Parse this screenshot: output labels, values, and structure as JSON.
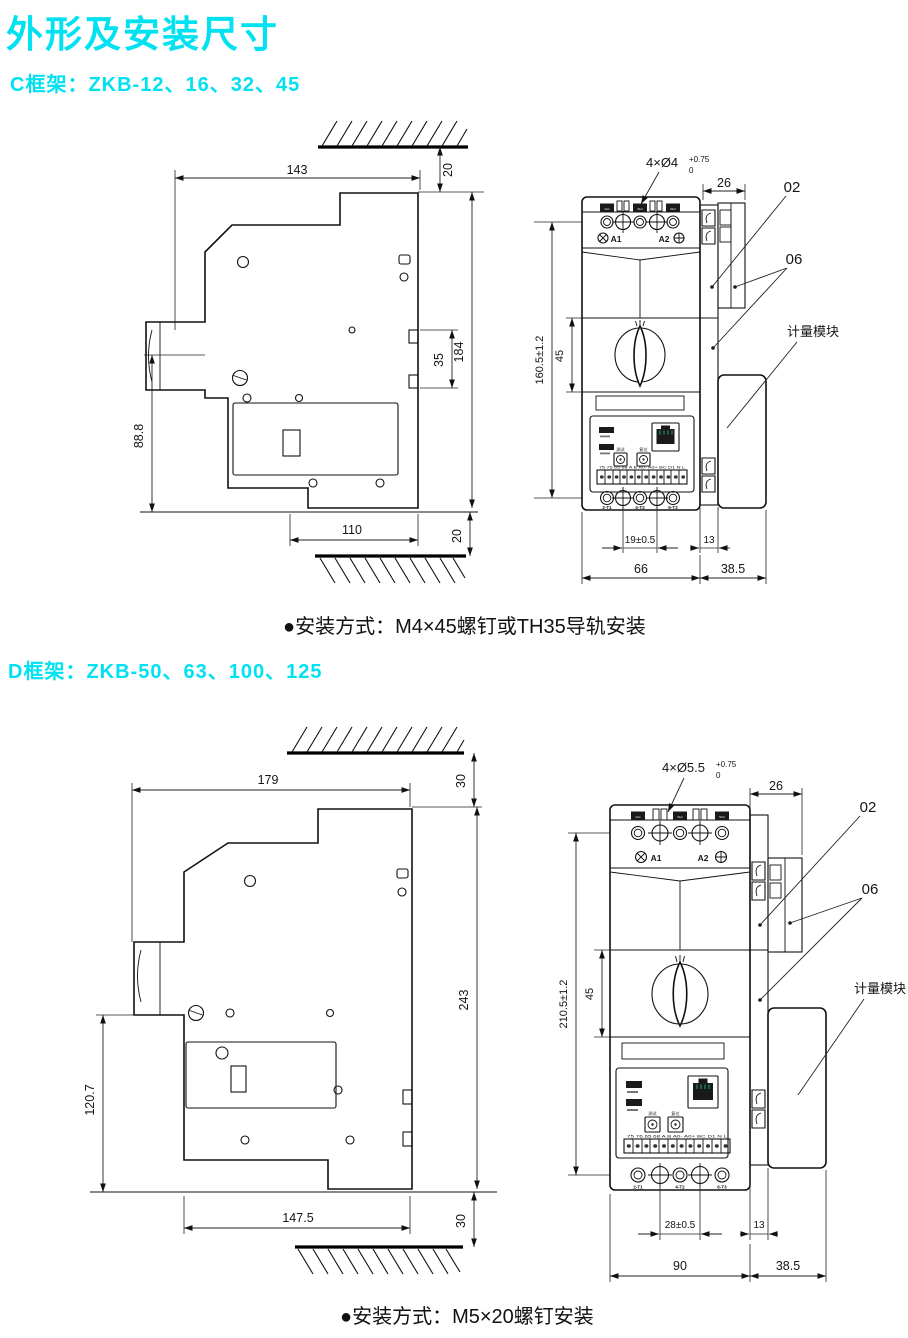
{
  "page": {
    "title": "外形及安装尺寸",
    "accent": "#00e1f2",
    "ink": "#141414",
    "bg": "#ffffff"
  },
  "c": {
    "heading": "C框架：ZKB-12、16、32、45",
    "note": "●安装方式：M4×45螺钉或TH35导轨安装",
    "side": {
      "w_top": "143",
      "gap_top": "20",
      "h_total": "184",
      "rail_h": "35",
      "h_front": "88.8",
      "w_bottom": "110",
      "gap_bottom": "20"
    },
    "front": {
      "holes": "4×Ø4",
      "tol_up": "+0.75",
      "tol_dn": "0",
      "depth": "26",
      "part02": "02",
      "part06": "06",
      "meter": "计量模块",
      "mount_h": "160.5±1.2",
      "handle_h": "45",
      "pitch": "19±0.5",
      "flange_w": "13",
      "body_w": "66",
      "meter_w": "38.5",
      "a1": "A1",
      "a2": "A2",
      "btn_test": "测试",
      "btn_reset": "复位",
      "top_terms": [
        "1/L1",
        "3/L2",
        "5/L3"
      ],
      "bot_terms": [
        "2-T1",
        "4-T2",
        "6-T3"
      ],
      "strip": "75 76 65 68 A B A0- A0+ BC D1 N L"
    }
  },
  "d": {
    "heading": "D框架：ZKB-50、63、100、125",
    "note": "●安装方式：M5×20螺钉安装",
    "side": {
      "w_top": "179",
      "gap_top": "30",
      "h_total": "243",
      "h_front": "120.7",
      "w_bottom": "147.5",
      "gap_bottom": "30"
    },
    "front": {
      "holes": "4×Ø5.5",
      "tol_up": "+0.75",
      "tol_dn": "0",
      "depth": "26",
      "part02": "02",
      "part06": "06",
      "meter": "计量模块",
      "mount_h": "210.5±1.2",
      "handle_h": "45",
      "pitch": "28±0.5",
      "flange_w": "13",
      "body_w": "90",
      "meter_w": "38.5",
      "a1": "A1",
      "a2": "A2",
      "btn_test": "测试",
      "btn_reset": "复位",
      "top_terms": [
        "1/L1",
        "3/L2",
        "5/L3"
      ],
      "bot_terms": [
        "2-T1",
        "4-T2",
        "6-T3"
      ],
      "strip": "75 76 65 68 A B A0- A0+ BC D1 N L"
    }
  }
}
